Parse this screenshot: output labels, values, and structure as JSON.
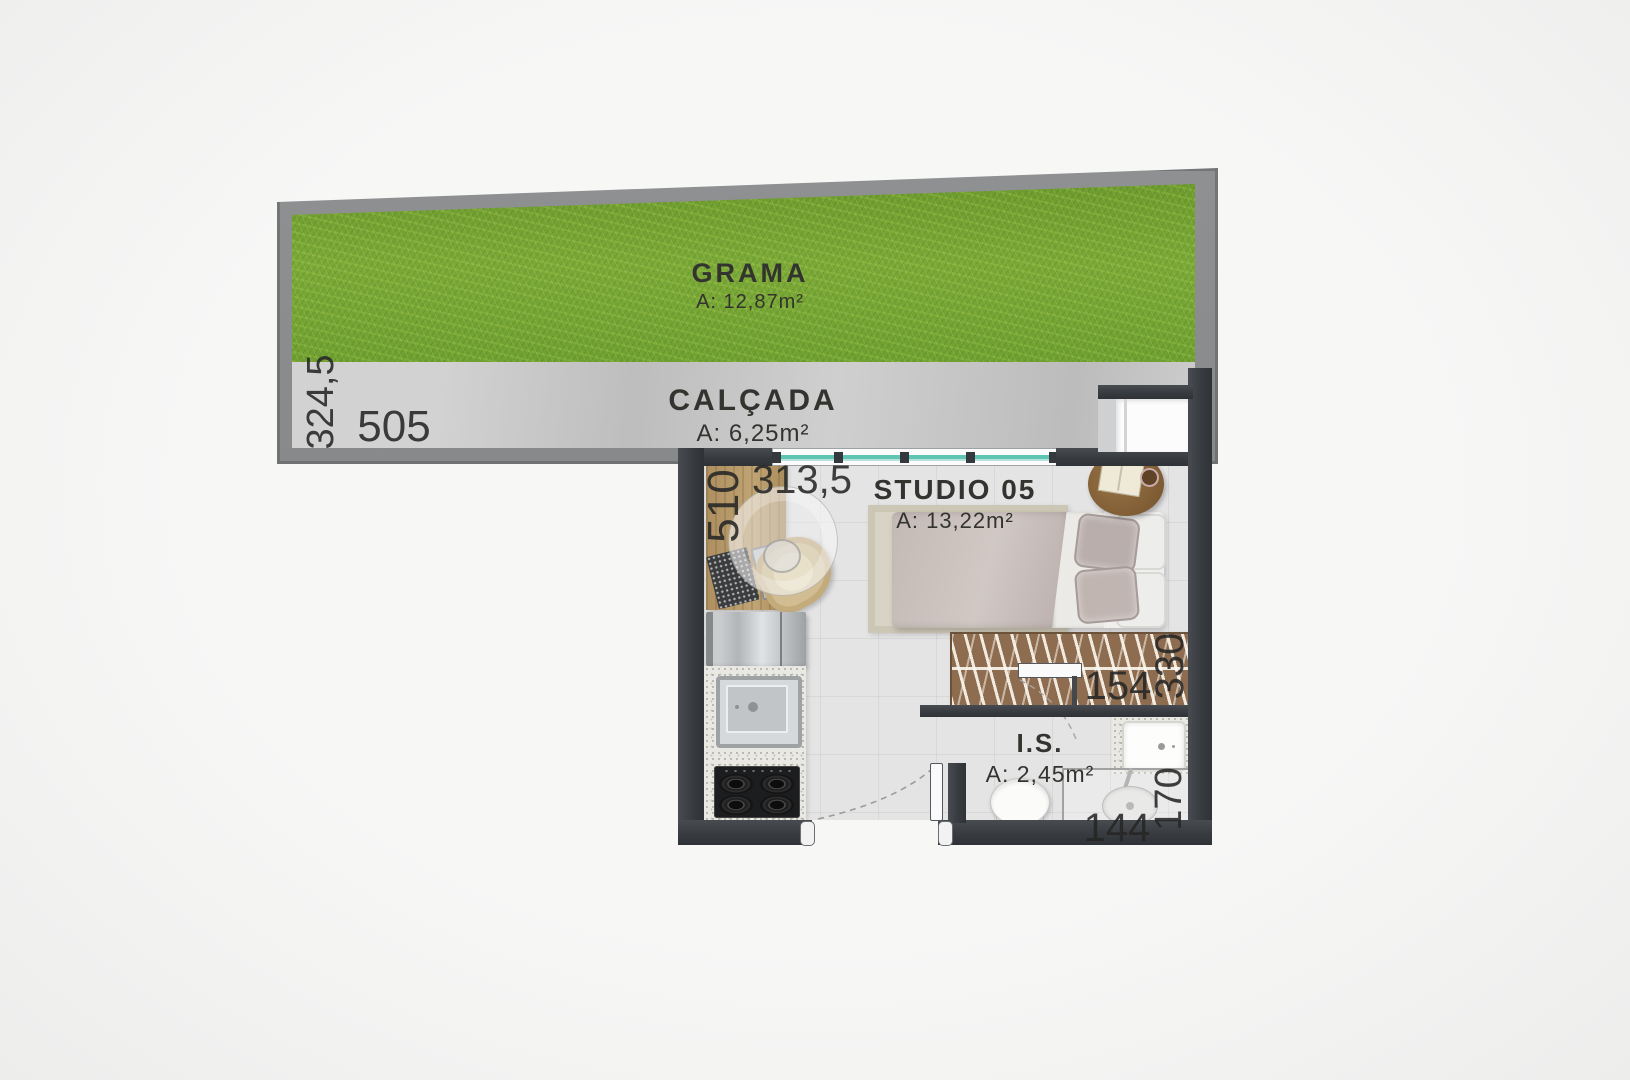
{
  "areas": {
    "grama": {
      "label": "GRAMA",
      "area": "A: 12,87m²"
    },
    "calcada": {
      "label": "CALÇADA",
      "area": "A: 6,25m²"
    },
    "studio": {
      "label": "STUDIO 05",
      "area": "A: 13,22m²"
    },
    "banheiro": {
      "label": "I.S.",
      "area": "A: 2,45m²"
    }
  },
  "dimensions": {
    "garden_depth": "324,5",
    "garden_width": "505",
    "studio_depth": "510",
    "studio_width": "313,5",
    "wardrobe_width": "154",
    "bath_side": "330",
    "shower_depth": "170",
    "shower_width": "144"
  },
  "colors": {
    "grass": "#74a233",
    "sidewalk": "#c6c6c6",
    "wall_dark": "#383b40",
    "wall_gray": "#8e9092",
    "floor": "#e4e4e5",
    "wood": "#b5996b",
    "wardrobe": "#8d6c4f",
    "window_glass": "#5fc4b2",
    "text": "#262626"
  },
  "furniture": [
    "desk",
    "laptop",
    "office-chair",
    "pendant-lamp",
    "refrigerator",
    "kitchen-sink",
    "cooktop",
    "double-bed",
    "side-table",
    "wardrobe",
    "toilet",
    "washbasin",
    "shower"
  ]
}
